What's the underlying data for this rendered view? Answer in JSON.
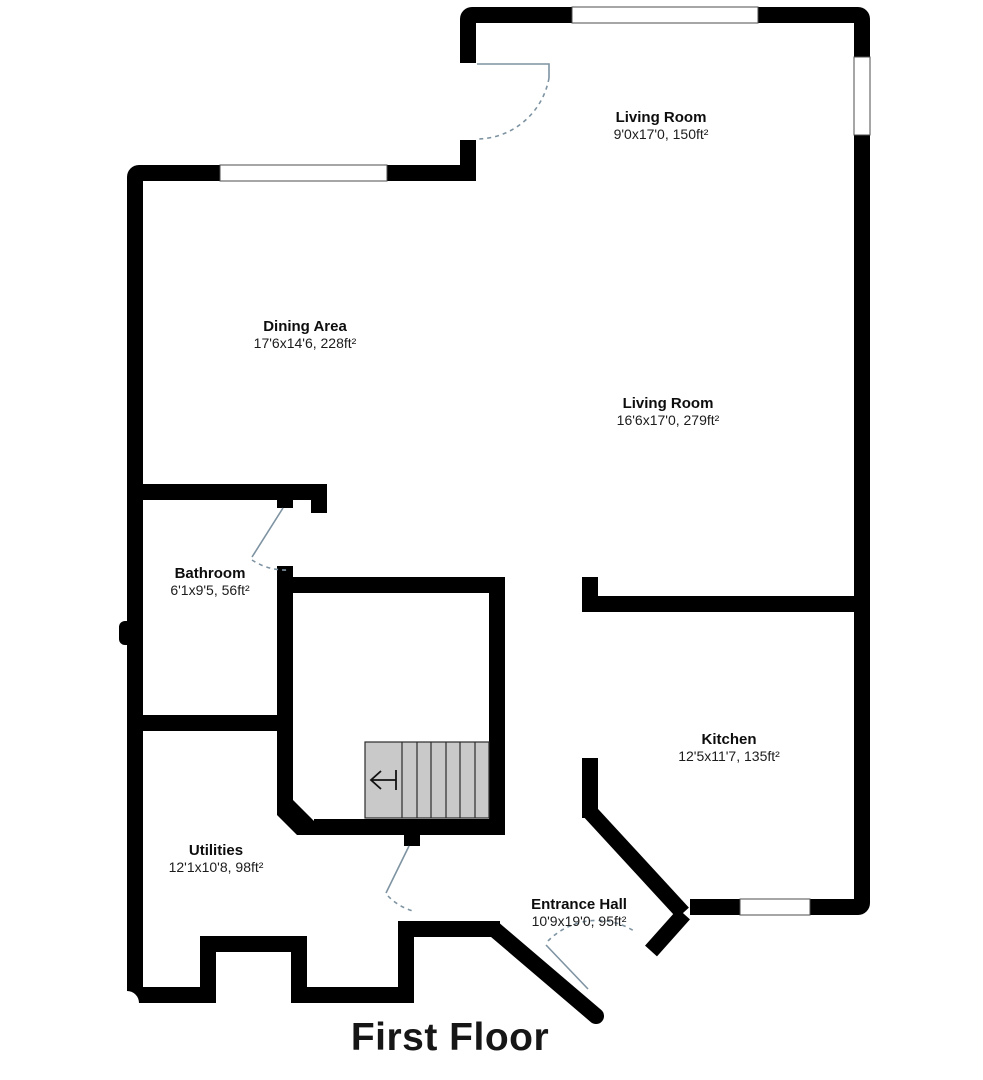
{
  "title": "First Floor",
  "rooms": [
    {
      "name": "Living Room",
      "dims": "9'0x17'0, 150ft²"
    },
    {
      "name": "Living Room",
      "dims": "16'6x17'0, 279ft²"
    },
    {
      "name": "Dining Area",
      "dims": "17'6x14'6, 228ft²"
    },
    {
      "name": "Bathroom",
      "dims": "6'1x9'5, 56ft²"
    },
    {
      "name": "Kitchen",
      "dims": "12'5x11'7, 135ft²"
    },
    {
      "name": "Utilities",
      "dims": "12'1x10'8, 98ft²"
    },
    {
      "name": "Entrance Hall",
      "dims": "10'9x19'0, 95ft²"
    }
  ],
  "stairs": {
    "direction_icon": "arrow-left-icon",
    "treads": 6
  },
  "features": {
    "windows": 4,
    "doors": 4
  },
  "colors": {
    "wall": "#000000",
    "stair_fill": "#c9c9c9",
    "door": "#7e93a2",
    "window_outline": "#4d4d4d",
    "background": "#ffffff"
  }
}
